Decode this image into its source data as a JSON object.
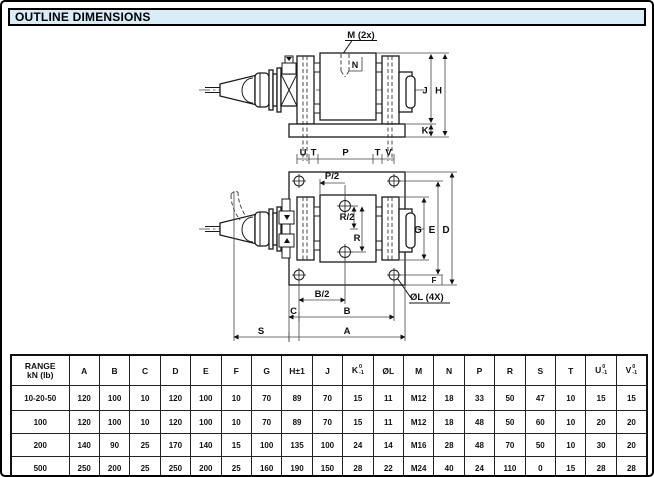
{
  "page": {
    "title": "OUTLINE DIMENSIONS"
  },
  "drawing": {
    "labels": {
      "m_2x": "M (2x)",
      "n": "N",
      "j": "J",
      "h": "H",
      "k": "K",
      "u": "U",
      "t_left": "T",
      "p": "P",
      "t_right": "T",
      "v": "V",
      "p_half": "P/2",
      "r_half": "R/2",
      "r": "R",
      "g": "G",
      "e": "E",
      "d": "D",
      "f": "F",
      "hole_callout": "ØL (4X)",
      "b_half": "B/2",
      "c": "C",
      "b": "B",
      "s": "S",
      "a": "A"
    }
  },
  "table": {
    "header": {
      "range_line1": "RANGE",
      "range_line2": "kN (lb)",
      "columns": [
        "A",
        "B",
        "C",
        "D",
        "E",
        "F",
        "G",
        "H±1",
        "J",
        "K",
        "ØL",
        "M",
        "N",
        "P",
        "R",
        "S",
        "T",
        "U",
        "V"
      ],
      "tolerance_columns": [
        "K",
        "U",
        "V"
      ],
      "tolerance_upper": "0",
      "tolerance_lower": "-1"
    },
    "rows": [
      {
        "range": "10-20-50",
        "values": [
          "120",
          "100",
          "10",
          "120",
          "100",
          "10",
          "70",
          "89",
          "70",
          "15",
          "11",
          "M12",
          "18",
          "33",
          "50",
          "47",
          "10",
          "15",
          "15"
        ]
      },
      {
        "range": "100",
        "values": [
          "120",
          "100",
          "10",
          "120",
          "100",
          "10",
          "70",
          "89",
          "70",
          "15",
          "11",
          "M12",
          "18",
          "48",
          "50",
          "60",
          "10",
          "20",
          "20"
        ]
      },
      {
        "range": "200",
        "values": [
          "140",
          "90",
          "25",
          "170",
          "140",
          "15",
          "100",
          "135",
          "100",
          "24",
          "14",
          "M16",
          "28",
          "48",
          "70",
          "50",
          "10",
          "30",
          "20"
        ]
      },
      {
        "range": "500",
        "values": [
          "250",
          "200",
          "25",
          "250",
          "200",
          "25",
          "160",
          "190",
          "150",
          "28",
          "22",
          "M24",
          "40",
          "24",
          "110",
          "0",
          "15",
          "28",
          "28"
        ]
      }
    ]
  }
}
